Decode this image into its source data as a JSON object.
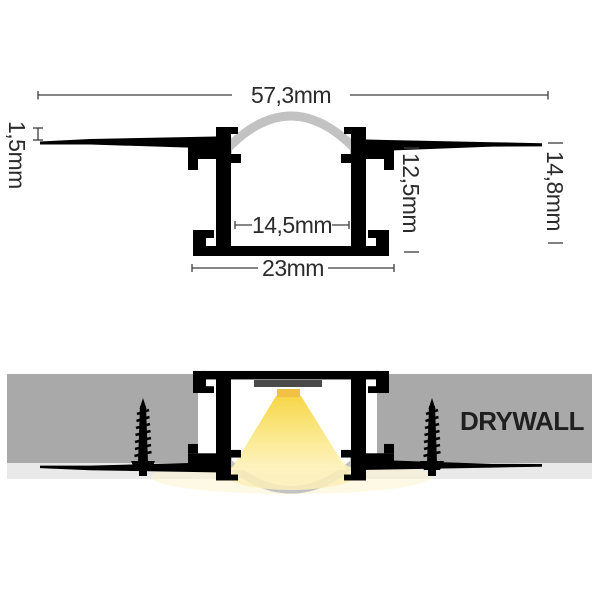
{
  "dimensions": {
    "total_width": "57,3mm",
    "flange_thickness": "1,5mm",
    "inner_width": "14,5mm",
    "base_width": "23mm",
    "inner_depth": "12,5mm",
    "total_height": "14,8mm"
  },
  "installation": {
    "wall_label": "DRYWALL"
  },
  "colors": {
    "profile": "#000000",
    "diffuser": "#c2c2c2",
    "drywall": "#a9a9a9",
    "skim_coat": "#e9e9e9",
    "pcb": "#4a4a4a",
    "led": "#f0c145",
    "cone_top": "#f7d647",
    "cone_mid": "#fbe98f",
    "cone_bottom": "#fdf3c2",
    "glow": "#fdf0b8",
    "glow_soft": "#fdf4cf",
    "dimension_line": "#3c3c3c",
    "screw": "#000000"
  }
}
